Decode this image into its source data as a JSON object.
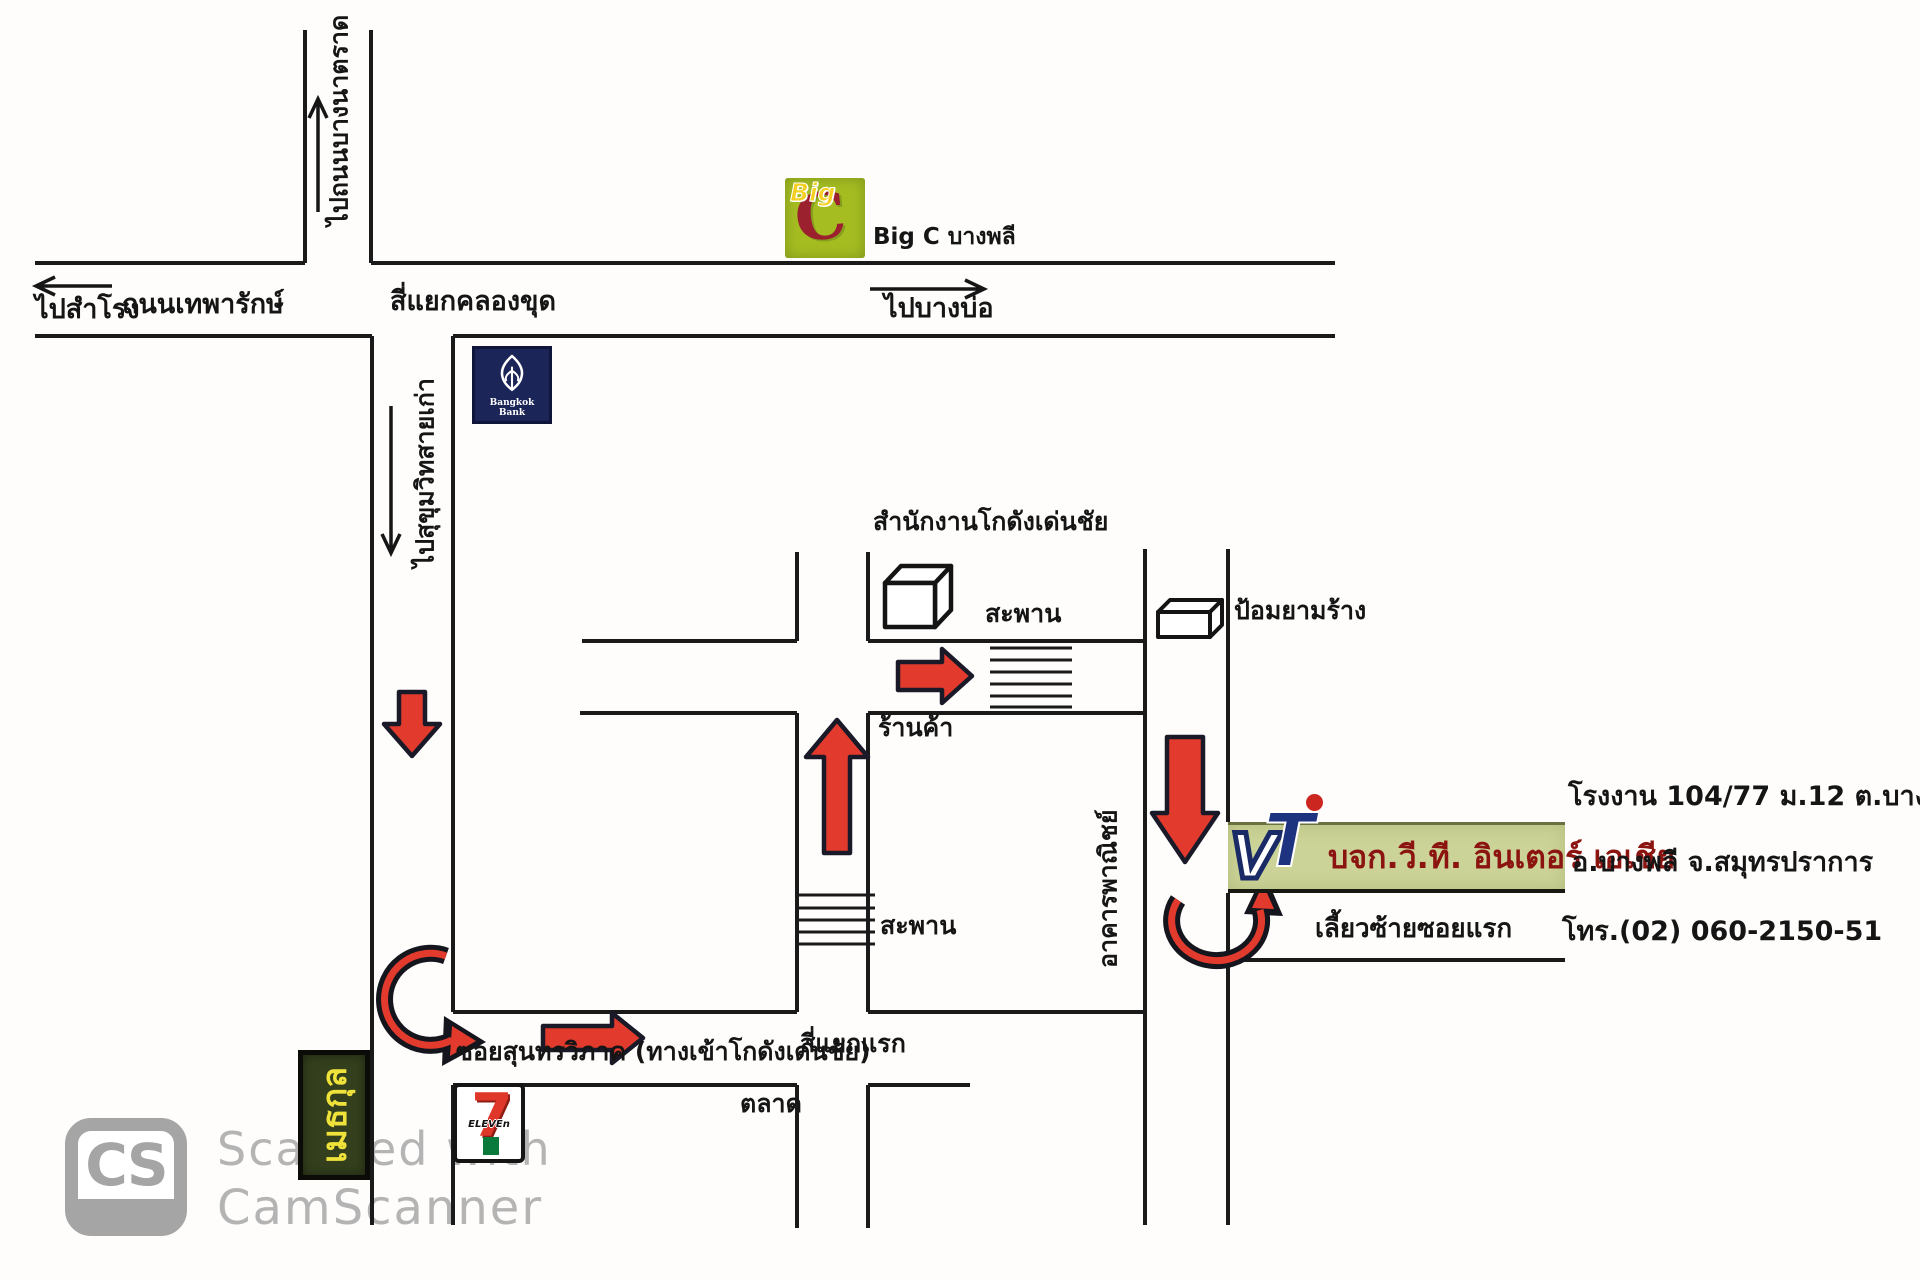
{
  "page": {
    "type": "scanned hand-drawn direction map",
    "language": "Thai"
  },
  "colors": {
    "road": "#1a1a1a",
    "arrow_red": "#e23b2e",
    "arrow_outline": "#191927",
    "banner_bg": "#ccd398",
    "banner_text": "#8b1410",
    "bigc_bg": "#a6bd22",
    "bigc_letter": "#9b212e",
    "bangkok_bank_bg": "#1b2557",
    "sign_bg": "#333f1d",
    "sign_text": "#efe23a",
    "watermark_grey": "#b4b4b4"
  },
  "directions": {
    "to_bangna_trad_road": "ไปถนนบางนาตราด",
    "to_samrong": "ไปสำโรง",
    "to_bang_bo": "ไปบางบ่อ",
    "to_old_sukhumvit": "ไปสุขุมวิทสายเก่า",
    "turn_left_first_soi": "เลี้ยวซ้ายซอยแรก"
  },
  "roads": {
    "thepharak_road": "ถนนเทพารักษ์",
    "khlong_khut_intersection": "สี่แยกคลองขุด",
    "soi_suntornvipak": "ซอยสุนทรวิภาค (ทางเข้าโกดังเด่นชัย)",
    "first_intersection": "สี่แยกแรก"
  },
  "places": {
    "big_c_label": "Big C บางพลี",
    "big_c_logo": {
      "word": "Big",
      "letter": "C"
    },
    "bangkok_bank_label": "Bangkok Bank",
    "warehouse_office": "สำนักงานโกดังเด่นชัย",
    "bridge_upper": "สะพาน",
    "bridge_lower": "สะพาน",
    "guard_post": "ป้อมยามร้าง",
    "shop": "ร้านค้า",
    "commercial_building": "อาคารพาณิชย์",
    "market": "ตลาด",
    "methakul_sign": "เมธกุล",
    "seven_eleven": {
      "seven": "7",
      "eleven": "ELEVEn"
    }
  },
  "company": {
    "name": "บจก.วี.ที. อินเตอร์ เอเชีย",
    "logo_v": "V",
    "logo_t": "T",
    "factory_address": "โรงงาน 104/77 ม.12 ต.บางปลา",
    "district_address": "อ.บางพลี จ.สมุทรปราการ",
    "phone": "โทร.(02) 060-2150-51"
  },
  "watermark": {
    "logo_text": "CS",
    "line1": "Scanned with",
    "line2": "CamScanner"
  },
  "icons": {
    "warehouse_cube_icon": "3d-cube outline",
    "guard_post_icon": "3d-flat-box outline",
    "bridge_hatch_icon": "ladder hatch lines",
    "route_arrow_icon": "red arrow with dark outline",
    "curved_turn_icon": "red curved arrow",
    "direction_arrow_icon": "thin black arrow",
    "bangkok_bank_lotus_icon": "white lotus emblem",
    "camscanner_cs_icon": "grey rounded CS badge"
  }
}
